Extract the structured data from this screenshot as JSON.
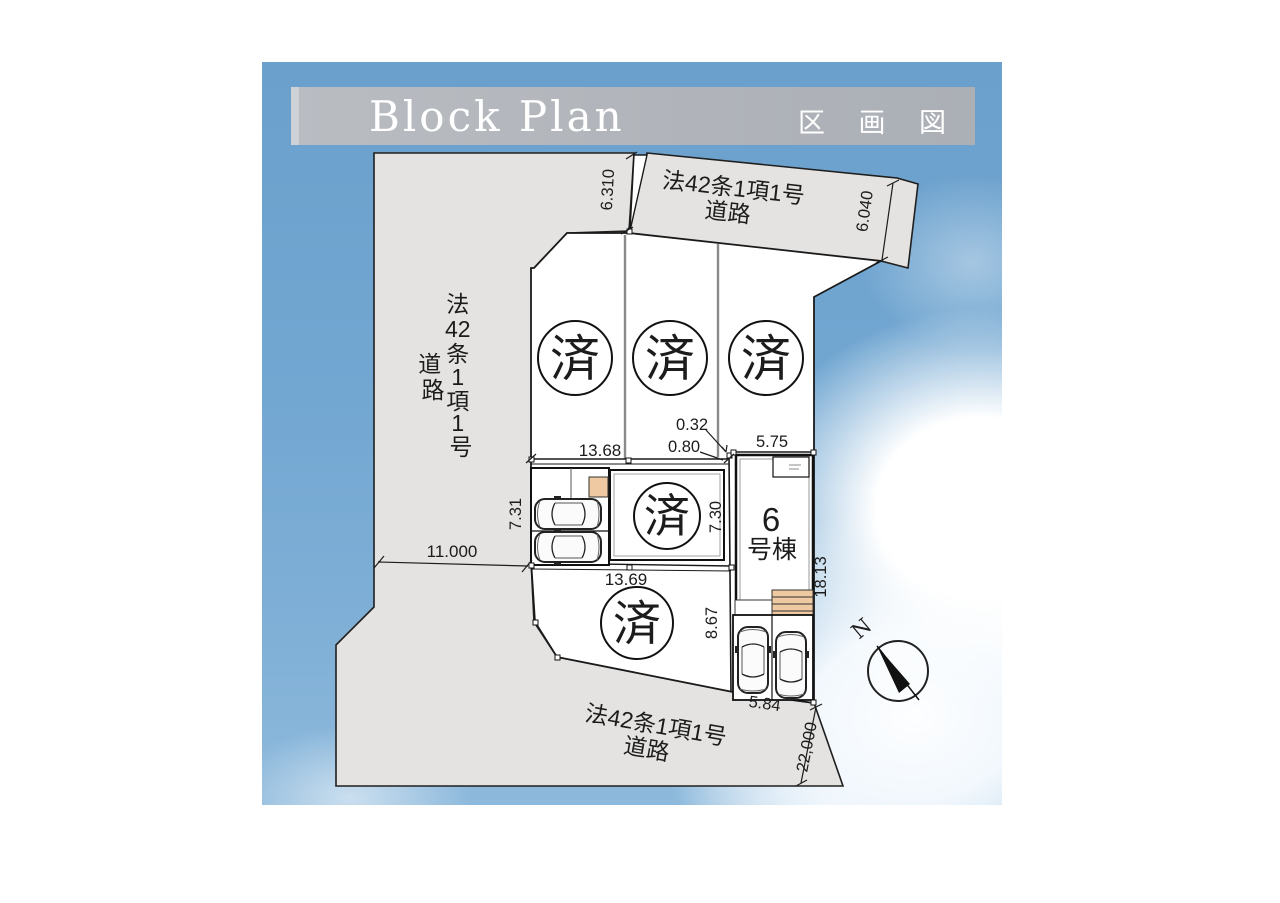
{
  "header": {
    "title_en": "Block Plan",
    "title_ja": "区 画 図"
  },
  "roads": {
    "top": {
      "line1": "法42条1項1号",
      "line2": "道路"
    },
    "bottom": {
      "line1": "法42条1項1号",
      "line2": "道路"
    },
    "left": {
      "chars": [
        "法",
        "42",
        "条",
        "1",
        "項",
        "1",
        "号"
      ],
      "road_chars": [
        "道",
        "路"
      ]
    }
  },
  "lots": {
    "sold_mark": "済",
    "unit6": {
      "number": "6",
      "label": "号棟"
    }
  },
  "compass": {
    "north": "N"
  },
  "dimensions": {
    "neck": "6.310",
    "top_road_end": "6.040",
    "gap_a": "0.32",
    "gap_b": "0.80",
    "lot6_frontage": "5.75",
    "upper_width": "13.68",
    "parking_depth": "7.31",
    "house_depth": "7.30",
    "left_road": "11.000",
    "lower_width": "13.69",
    "lot6_depth": "18.13",
    "bottom_lot_depth": "8.67",
    "bottom_parking_width": "5.84",
    "bottom_road": "22,000"
  }
}
